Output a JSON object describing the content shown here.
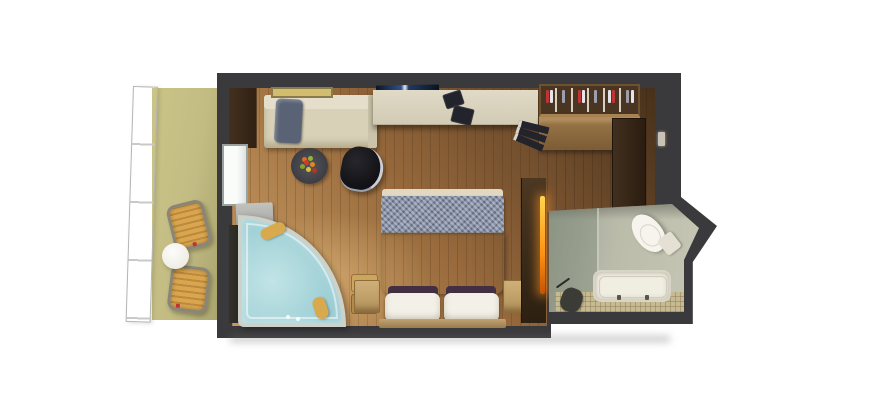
{
  "canvas": {
    "width": 881,
    "height": 400,
    "description": "3D top-down floor plan rendering of a cruise ship balcony stateroom with en-suite bathroom",
    "background": "#ffffff"
  },
  "palette": {
    "bg": "#ffffff",
    "wall": "#3a393b",
    "wood_light": "#c59a66",
    "wood_mid": "#97693c",
    "wood_dark": "#64462a",
    "balcony_floor": "#c2bc83",
    "railing": "#fafafa",
    "chair_slat": "#d9a54f",
    "chair_slat_dark": "#bc8a3c",
    "table": "#f0ede6",
    "sofa": "#d8d1b8",
    "sofa_back": "#e4deca",
    "sofa_pillow": "#5a6275",
    "lounge_black": "#121216",
    "rug": "#3b3b41",
    "runner_blue": "#8690a6",
    "duvet": "#e0d8c0",
    "pillow_white": "#f3f0e7",
    "pillow_purple": "#432f42",
    "headboard": "#9a7c4e",
    "nightstand": "#b2925c",
    "desk": "#d2cbb5",
    "closet_back": "#4a3422",
    "closet_wood": "#7c5c36",
    "hanger_red": "#c03434",
    "hanger_white": "#e6e6ea",
    "hanger_gray": "#9aa0ac",
    "entry_wood": "#2a1c10",
    "divider_wood": "#2c2012",
    "glow": "#ff9012",
    "bath_floor": "#bcbcab",
    "mosaic": "#c6ba92",
    "tub": "#f0ede1",
    "water": "#9fd0d6",
    "water_light": "#c2e4e6",
    "glass_rim": "#ccd1c9",
    "spa_pillow": "#d9a94e",
    "step_top": "#cda55c",
    "step_bottom": "#b68a46",
    "window_glass": "#fafcfa",
    "bench_gray": "#a8a8a4",
    "vanity_dark": "#201d18",
    "art": "#d2bd6e",
    "tv_blue": "#30508a"
  },
  "scene": {
    "balcony": {
      "items": [
        "glass-railing",
        "deck-chair",
        "deck-chair",
        "round-cocktail-table"
      ]
    },
    "stateroom": {
      "items": [
        "corner-cabinet",
        "sofa-with-pillow",
        "wall-art",
        "wall-tv",
        "writing-desk",
        "desk-chair",
        "open-closet-with-hangers",
        "book-stack",
        "black-lounge-chair",
        "round-rug",
        "double-bed",
        "nightstand-left",
        "nightstand-right",
        "corner-whirlpool-tub",
        "step-stool",
        "dark-vanity",
        "balcony-window",
        "entry-door",
        "light-switch",
        "illuminated-divider"
      ]
    },
    "bathroom": {
      "items": [
        "toilet",
        "bathtub",
        "shower-area",
        "mosaic-tile-floor"
      ]
    }
  }
}
